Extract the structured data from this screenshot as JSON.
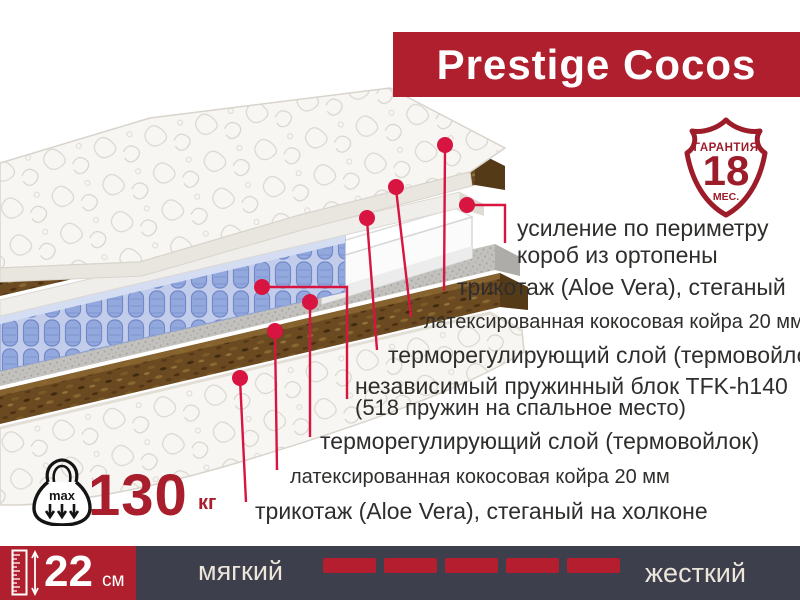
{
  "banner": {
    "title": "Prestige Cocos",
    "bg_color": "#b01f2e"
  },
  "badge": {
    "top_label": "ГАРАНТИЯ",
    "number": "18",
    "bottom_label": "МЕС.",
    "color": "#9c1c2a"
  },
  "annotations": [
    {
      "id": "perimeter-box",
      "lines": [
        "усиление по периметру",
        "короб из ортопены"
      ]
    },
    {
      "id": "knit-top",
      "text": "трикотаж (Aloe Vera), стеганый"
    },
    {
      "id": "coir-top",
      "text": "латексированная кокосовая койра 20 мм"
    },
    {
      "id": "thermo-top",
      "text": "терморегулирующий слой (термовойлок)"
    },
    {
      "id": "spring-block",
      "lines": [
        "независимый пружинный блок TFK-h140",
        "(518 пружин на спальное место)"
      ]
    },
    {
      "id": "thermo-bottom",
      "text": "терморегулирующий слой (термовойлок)"
    },
    {
      "id": "coir-bottom",
      "text": "латексированная кокосовая койра 20 мм"
    },
    {
      "id": "knit-bottom",
      "text": "трикотаж (Aloe Vera), стеганый на холконе"
    }
  ],
  "weight": {
    "max_label": "max",
    "value": "130",
    "unit": "кг"
  },
  "bottom_bar": {
    "height_value": "22",
    "height_unit": "см",
    "soft_label": "мягкий",
    "hard_label": "жесткий",
    "dash_count": 5
  },
  "colors": {
    "banner_red": "#b01f2e",
    "callout_red": "#d81440",
    "navy_bar": "#3e3f4d",
    "badge_red": "#9c1c2a",
    "weight_red": "#a81e2c",
    "text": "#2f2e2c"
  }
}
